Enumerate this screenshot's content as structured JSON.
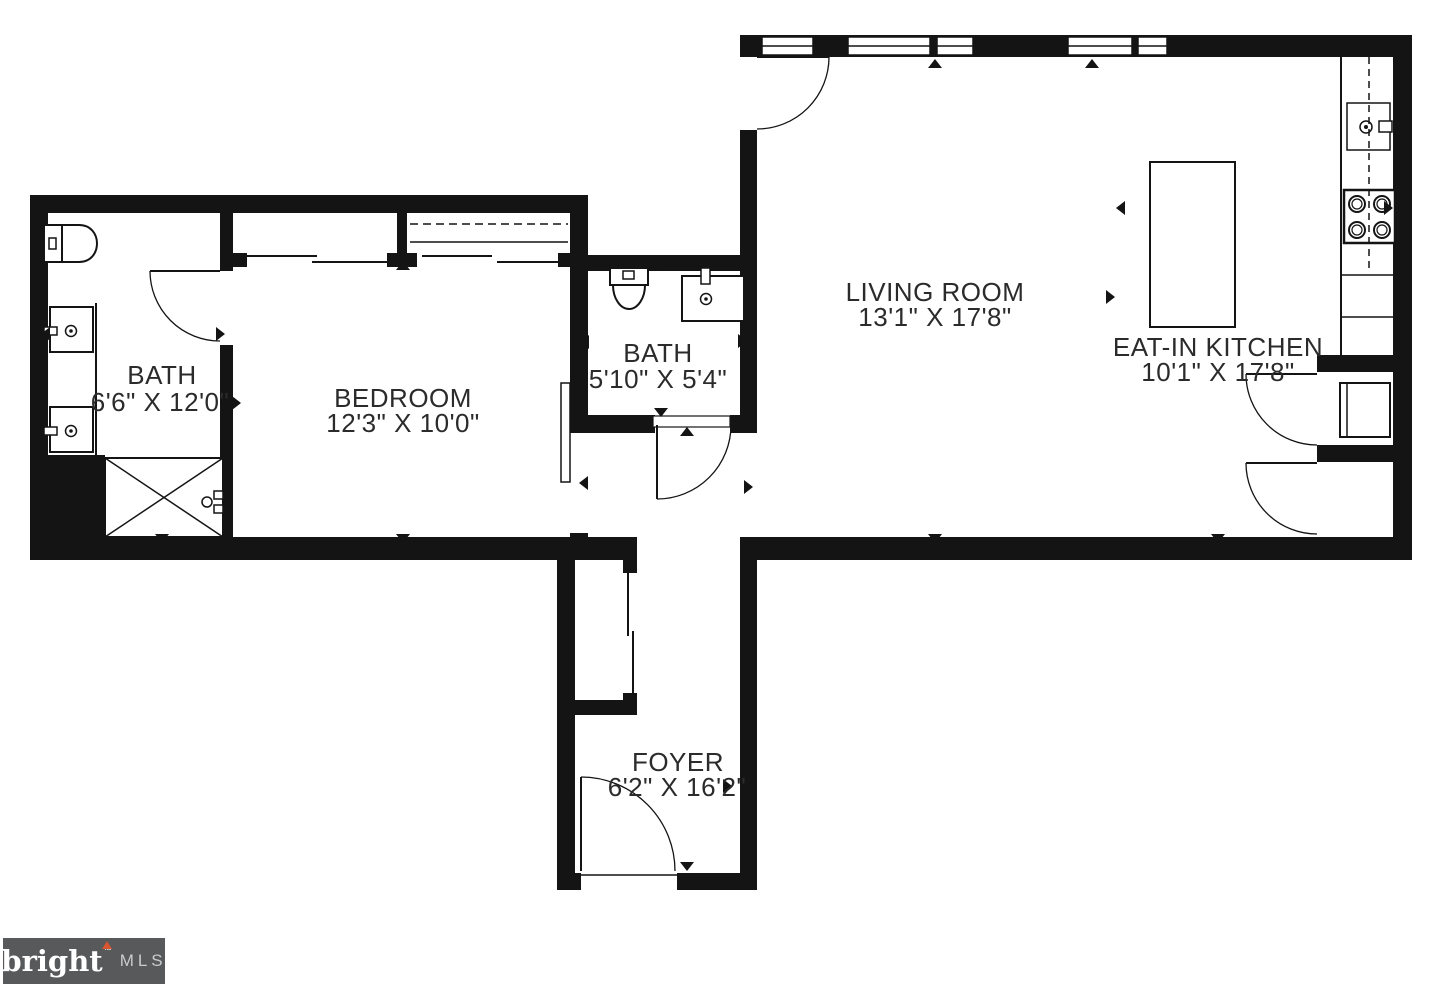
{
  "plan": {
    "background": "#ffffff",
    "line_color": "#141414",
    "label_color": "#2b2b2b",
    "rooms": [
      {
        "id": "bath-main",
        "name": "BATH",
        "dims": "6'6\" X 12'0\""
      },
      {
        "id": "bedroom",
        "name": "BEDROOM",
        "dims": "12'3\" X 10'0\""
      },
      {
        "id": "bath-small",
        "name": "BATH",
        "dims": "5'10\" X 5'4\""
      },
      {
        "id": "living-room",
        "name": "LIVING ROOM",
        "dims": "13'1\" X 17'8\""
      },
      {
        "id": "eat-in-kitchen",
        "name": "EAT-IN KITCHEN",
        "dims": "10'1\" X 17'8\""
      },
      {
        "id": "foyer",
        "name": "FOYER",
        "dims": "6'2\" X 16'2\""
      }
    ],
    "fixtures": [
      "toilet",
      "vanity-sink",
      "vanity-sink",
      "shower",
      "toilet",
      "sink",
      "kitchen-sink",
      "stove",
      "kitchen-island",
      "washer",
      "closet",
      "sliding-doors"
    ]
  },
  "logo": {
    "brand": "bright",
    "tm": "™",
    "suffix": "MLS",
    "bg_color": "#58595b",
    "brand_color": "#ffffff",
    "suffix_color": "#c9cbcd",
    "accent_color": "#d8552f"
  }
}
